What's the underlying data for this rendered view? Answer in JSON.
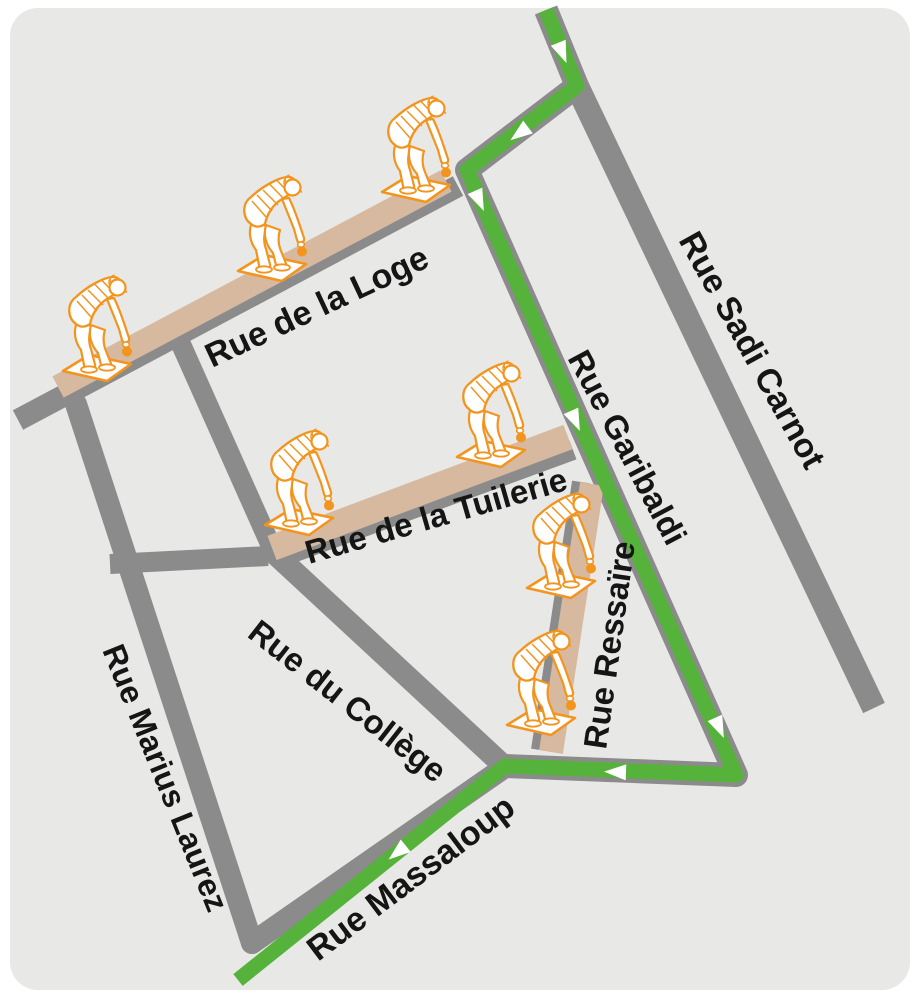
{
  "map": {
    "background": "#e8e8e6",
    "frame_color": "#ffffff",
    "road_color": "#8b8b8b",
    "piste_color": "#d6b99f",
    "route_color": "#55b23a",
    "arrow_color": "#ffffff",
    "figure_color": "#f2941e",
    "label_color": "#151515",
    "figure_meaning": "petanque player bending with boule on piste mat",
    "roads": [
      {
        "id": "sadi-carnot-road",
        "path": [
          [
            577,
            86
          ],
          [
            874,
            708
          ]
        ],
        "width": 24,
        "cap": "butt"
      },
      {
        "id": "route-backbone-road",
        "path": [
          [
            546,
            10
          ],
          [
            577,
            86
          ],
          [
            467,
            170
          ],
          [
            736,
            775
          ],
          [
            505,
            766
          ]
        ],
        "width": 24,
        "cap": "butt"
      },
      {
        "id": "loge-road",
        "path": [
          [
            18,
            420
          ],
          [
            458,
            186
          ]
        ],
        "width": 22,
        "cap": "butt"
      },
      {
        "id": "marius-laurez-road",
        "path": [
          [
            76,
            404
          ],
          [
            252,
            943
          ]
        ],
        "width": 22,
        "cap": "round"
      },
      {
        "id": "massaloup-road",
        "path": [
          [
            252,
            943
          ],
          [
            505,
            767
          ]
        ],
        "width": 22,
        "cap": "round"
      },
      {
        "id": "college-upper-road",
        "path": [
          [
            180,
            342
          ],
          [
            275,
            555
          ]
        ],
        "width": 20,
        "cap": "butt"
      },
      {
        "id": "cross-street-road",
        "path": [
          [
            110,
            564
          ],
          [
            268,
            556
          ]
        ],
        "width": 20,
        "cap": "butt"
      },
      {
        "id": "college-road",
        "path": [
          [
            273,
            552
          ],
          [
            505,
            767
          ]
        ],
        "width": 22,
        "cap": "butt"
      },
      {
        "id": "tuilerie-road",
        "path": [
          [
            276,
            559
          ],
          [
            573,
            450
          ]
        ],
        "width": 20,
        "cap": "butt"
      },
      {
        "id": "ressaire-road",
        "path": [
          [
            581,
            482
          ],
          [
            540,
            750
          ]
        ],
        "width": 18,
        "cap": "butt"
      }
    ],
    "pistes": [
      {
        "id": "loge-piste",
        "path": [
          [
            58,
            387
          ],
          [
            446,
            181
          ]
        ],
        "width": 24
      },
      {
        "id": "tuilerie-piste",
        "path": [
          [
            272,
            548
          ],
          [
            568,
            437
          ]
        ],
        "width": 26
      },
      {
        "id": "ressaire-piste",
        "path": [
          [
            592,
            484
          ],
          [
            551,
            752
          ]
        ],
        "width": 24
      }
    ],
    "labels": [
      {
        "id": "loge",
        "text": "Rue de la Loge",
        "x": 212,
        "y": 368,
        "angle": -25,
        "size": 34
      },
      {
        "id": "sadi-carnot",
        "text": "Rue Sadi Carnot",
        "x": 678,
        "y": 240,
        "angle": 61,
        "size": 34
      },
      {
        "id": "garibaldi",
        "text": "Rue Garibaldi",
        "x": 567,
        "y": 358,
        "angle": 62,
        "size": 33
      },
      {
        "id": "tuilerie",
        "text": "Rue de la Tuilerie",
        "x": 309,
        "y": 564,
        "angle": -16,
        "size": 33
      },
      {
        "id": "ressaire",
        "text": "Rue Ressaïre",
        "x": 606,
        "y": 750,
        "angle": -82,
        "size": 33
      },
      {
        "id": "college",
        "text": "Rue du Collège",
        "x": 246,
        "y": 636,
        "angle": 38,
        "size": 33
      },
      {
        "id": "marius-laurez",
        "text": "Rue Marius Laurez",
        "x": 102,
        "y": 650,
        "angle": 68,
        "size": 32
      },
      {
        "id": "massaloup",
        "text": "Rue Massaloup",
        "x": 318,
        "y": 962,
        "angle": -37,
        "size": 34
      }
    ],
    "route": {
      "path": [
        [
          546,
          10
        ],
        [
          577,
          86
        ],
        [
          467,
          170
        ],
        [
          736,
          775
        ],
        [
          505,
          766
        ],
        [
          238,
          980
        ]
      ],
      "width": 15,
      "arrows": [
        {
          "x": 562,
          "y": 52,
          "angle": 68
        },
        {
          "x": 520,
          "y": 133,
          "angle": 143
        },
        {
          "x": 479,
          "y": 200,
          "angle": 66
        },
        {
          "x": 575,
          "y": 420,
          "angle": 66
        },
        {
          "x": 719,
          "y": 727,
          "angle": 66
        },
        {
          "x": 616,
          "y": 772,
          "angle": 182
        },
        {
          "x": 398,
          "y": 852,
          "angle": 141
        }
      ]
    },
    "figures": [
      {
        "x": 58,
        "y": 272
      },
      {
        "x": 233,
        "y": 172
      },
      {
        "x": 377,
        "y": 93
      },
      {
        "x": 260,
        "y": 426
      },
      {
        "x": 452,
        "y": 358
      },
      {
        "x": 522,
        "y": 489
      },
      {
        "x": 502,
        "y": 626
      }
    ]
  }
}
